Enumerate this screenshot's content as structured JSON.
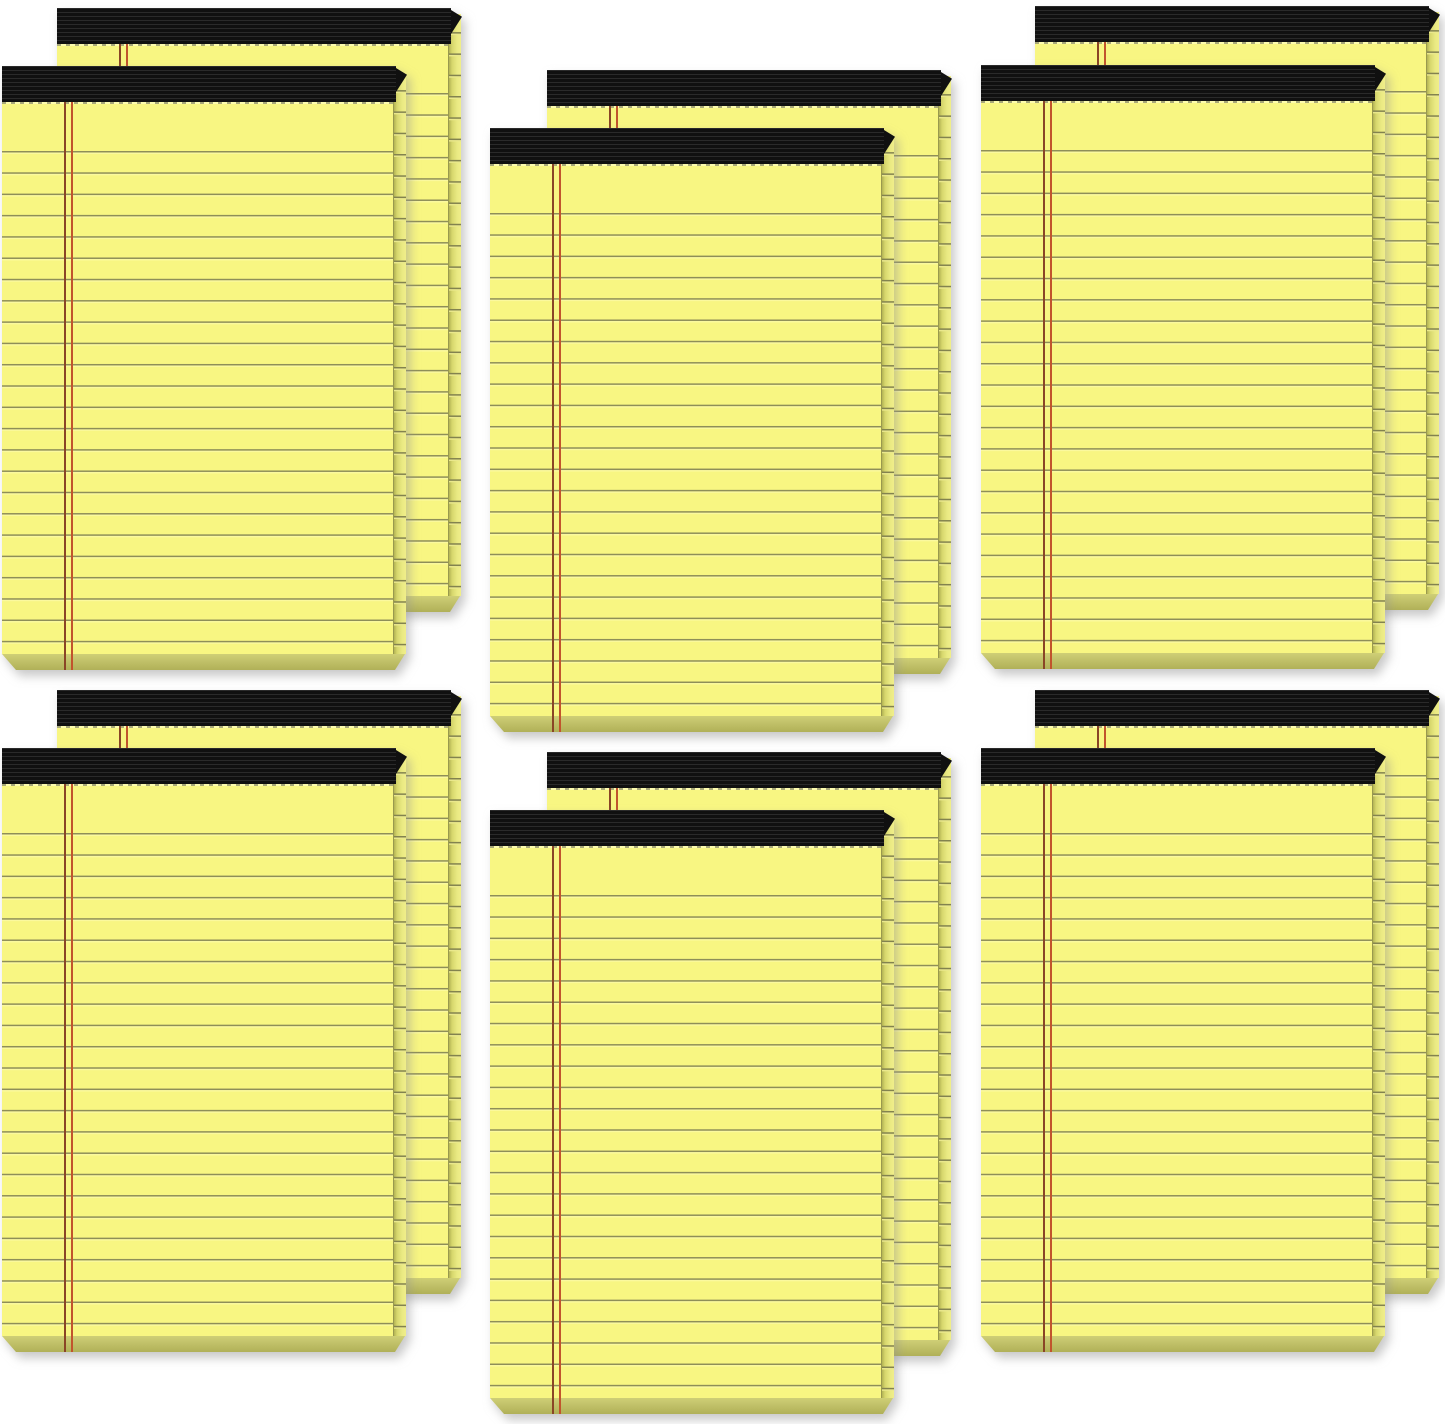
{
  "scene": {
    "description": "Product photo of 12 canary-yellow ruled legal note pads with black tape bindings, arranged as 6 overlapping pairs (2 rows x 3 columns) on a plain white background",
    "background_color": "#ffffff",
    "pad_count": 12,
    "stack_count": 6,
    "grid": {
      "rows": 2,
      "cols": 3
    }
  },
  "pad_style": {
    "paper_color": "#f8f682",
    "rule_color": "#8e8e58",
    "rule_highlight": "#fbf99e",
    "margin_outer": "#8a4526",
    "margin_inner": "#c1542d",
    "binding_base": "#101010",
    "binding_ridge": "#2a2a2a",
    "perforation_dash": "#a8a878",
    "perforation_gap": "#fdfcae",
    "edge_line": "#99994e",
    "edge_dark": "#b3b354",
    "edge_mid": "#d6d66c",
    "edge_light": "#e9e982",
    "edge_lighter": "#f0ee8a",
    "edge_rule": "#82824f",
    "edge_rule_hi": "#eae88c",
    "bevel_top": "#cfcf76",
    "bevel_bottom": "#b0b058",
    "pad_width": 403,
    "pad_height": 604,
    "face_width": 391,
    "face_height": 588,
    "edge_width": 12,
    "bevel_height": 16,
    "binding_height": 36,
    "rule_spacing": 21.3,
    "first_rule_offset": 85,
    "margin_left": 62
  },
  "pads": [
    {
      "stack": 1,
      "layer": "back",
      "x": 57,
      "y": 8
    },
    {
      "stack": 1,
      "layer": "front",
      "x": 2,
      "y": 66
    },
    {
      "stack": 2,
      "layer": "back",
      "x": 547,
      "y": 70
    },
    {
      "stack": 2,
      "layer": "front",
      "x": 490,
      "y": 128
    },
    {
      "stack": 3,
      "layer": "back",
      "x": 1035,
      "y": 6
    },
    {
      "stack": 3,
      "layer": "front",
      "x": 981,
      "y": 65
    },
    {
      "stack": 4,
      "layer": "back",
      "x": 57,
      "y": 690
    },
    {
      "stack": 4,
      "layer": "front",
      "x": 2,
      "y": 748
    },
    {
      "stack": 5,
      "layer": "back",
      "x": 547,
      "y": 752
    },
    {
      "stack": 5,
      "layer": "front",
      "x": 490,
      "y": 810
    },
    {
      "stack": 6,
      "layer": "back",
      "x": 1035,
      "y": 690
    },
    {
      "stack": 6,
      "layer": "front",
      "x": 981,
      "y": 748
    }
  ]
}
